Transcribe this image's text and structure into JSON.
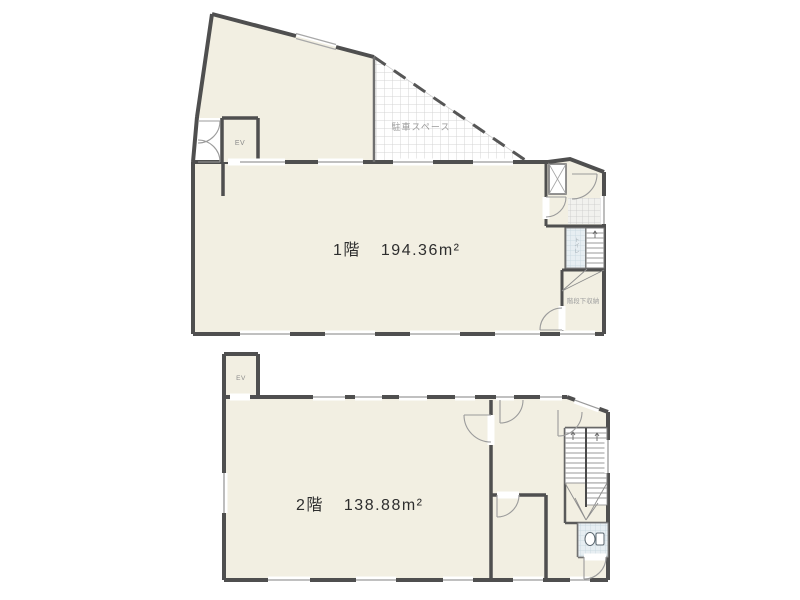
{
  "colors": {
    "wall": "#4f4f4f",
    "room_fill": "#f2efe2",
    "white": "#ffffff"
  },
  "floor1": {
    "name": "1階",
    "area": "194.36m²",
    "ev": "EV",
    "parking": "駐車スペース",
    "under_stair_storage": "階段下収納",
    "toilet": "トイレ"
  },
  "floor2": {
    "name": "2階",
    "area": "138.88m²",
    "ev": "EV"
  }
}
